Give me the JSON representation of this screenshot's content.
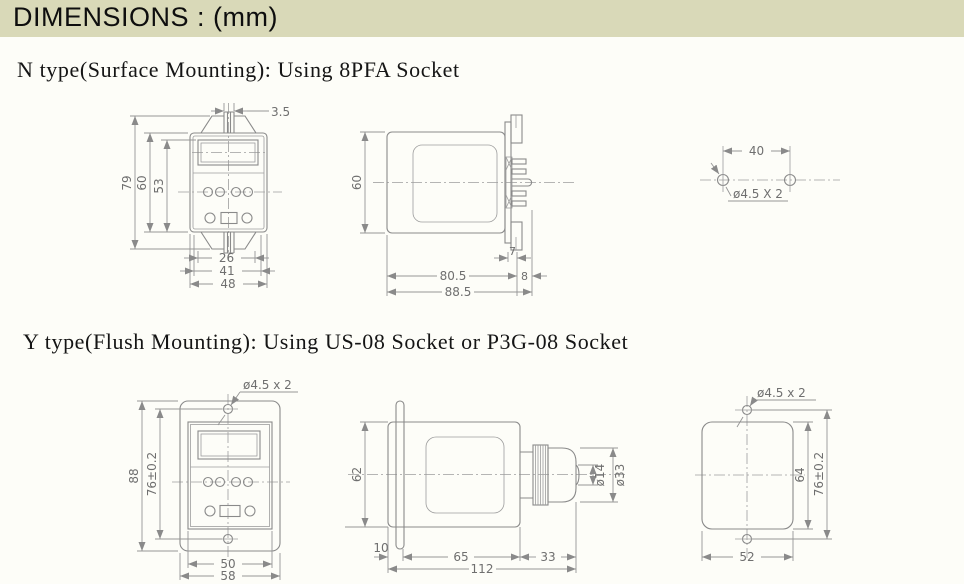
{
  "header": {
    "title": "DIMENSIONS : (mm)"
  },
  "sections": {
    "n_type": {
      "title": "N type(Surface Mounting): Using 8PFA Socket",
      "front": {
        "clip_width": "3.5",
        "overall_height": "79",
        "body_height": "60",
        "panel_height": "53",
        "inner_width": "26",
        "mid_width": "41",
        "body_width": "48"
      },
      "side": {
        "body_height": "60",
        "bracket_depth": "7",
        "body_length": "80.5",
        "pin_length": "8",
        "overall_length": "88.5"
      },
      "holes": {
        "spacing": "40",
        "hole_label": "ø4.5 X 2"
      }
    },
    "y_type": {
      "title": "Y type(Flush Mounting): Using US-08 Socket or P3G-08 Socket",
      "front": {
        "hole_label": "ø4.5 x 2",
        "overall_height": "88",
        "hole_spacing": "76±0.2",
        "panel_width": "50",
        "overall_width": "58"
      },
      "side": {
        "body_height": "62",
        "flange_depth": "10",
        "body_length": "65",
        "socket_length": "33",
        "overall_length": "112",
        "inner_dia": "ø14",
        "outer_dia": "ø33"
      },
      "cutout": {
        "hole_label": "ø4.5 x 2",
        "cutout_height": "64",
        "hole_spacing": "76±0.2",
        "cutout_width": "52"
      }
    }
  }
}
